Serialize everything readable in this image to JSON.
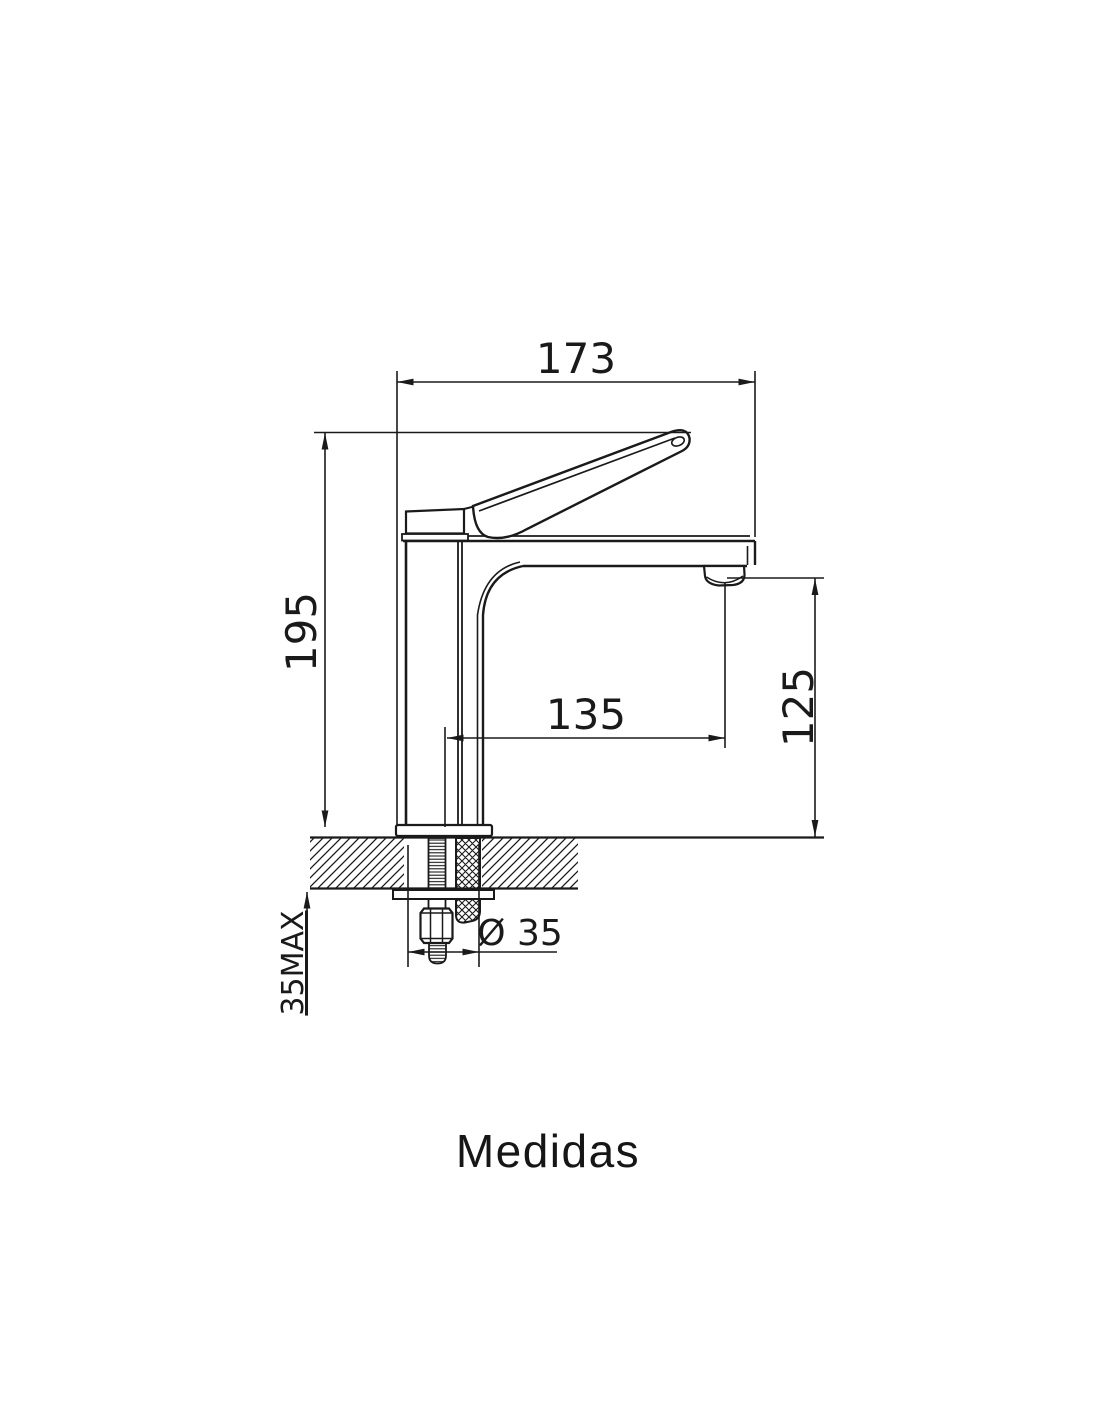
{
  "title": {
    "text": "Medidas"
  },
  "drawing": {
    "type": "technical-dimension-drawing",
    "subject": "single-lever basin mixer tap, side elevation with countertop cross-section",
    "dimensions": {
      "overall_width": {
        "label": "173"
      },
      "overall_height": {
        "label": "195"
      },
      "spout_reach": {
        "label": "135"
      },
      "spout_height": {
        "label": "125"
      },
      "hole_diameter": {
        "label": "Ø 35"
      },
      "max_deck_thickness": {
        "label": "35MAX"
      }
    }
  },
  "colors": {
    "line": "#1a1a1a",
    "background": "#ffffff"
  }
}
